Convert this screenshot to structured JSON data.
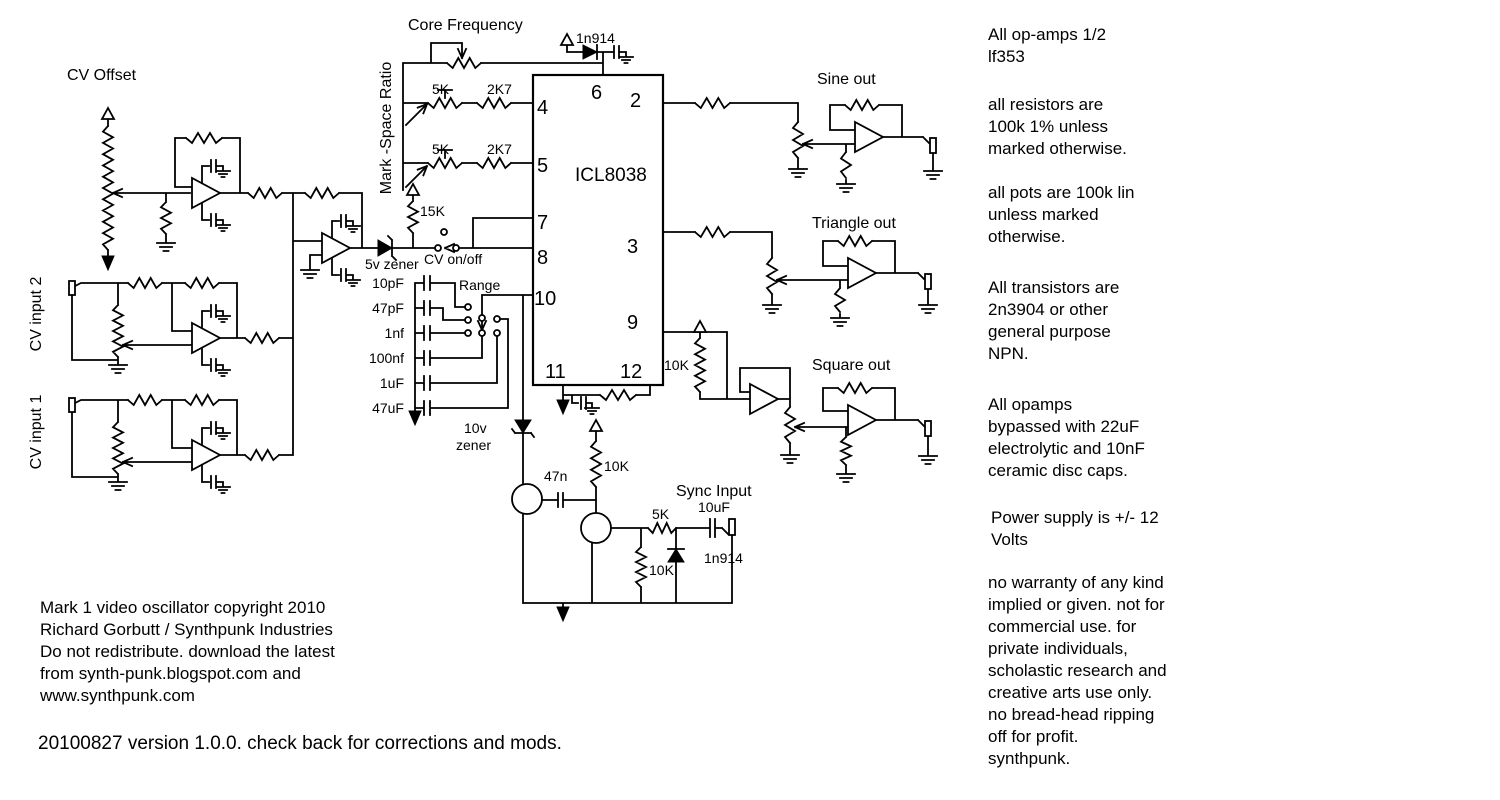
{
  "schematic": {
    "labels": {
      "core_frequency": "Core Frequency",
      "cv_offset": "CV Offset",
      "mark_space_ratio": "Mark -Space Ratio",
      "cv_input_2": "CV input 2",
      "cv_input_1": "CV input 1",
      "sine_out": "Sine out",
      "triangle_out": "Triangle out",
      "square_out": "Square out",
      "sync_input": "Sync Input",
      "range": "Range",
      "cv_on_off": "CV on/off",
      "zener_5v": "5v zener",
      "zener_10v_line1": "10v",
      "zener_10v_line2": "zener"
    },
    "chip": {
      "name": "ICL8038",
      "pins": {
        "p2": "2",
        "p3": "3",
        "p4": "4",
        "p5": "5",
        "p6": "6",
        "p7": "7",
        "p8": "8",
        "p9": "9",
        "p10": "10",
        "p11": "11",
        "p12": "12"
      }
    },
    "values": {
      "diode_core": "1n914",
      "pot_5k_top": "5K",
      "res_2k7_top": "2K7",
      "pot_5k_bottom": "5K",
      "res_2k7_bottom": "2K7",
      "res_15k": "15K",
      "timing_caps": [
        "10pF",
        "47pF",
        "1nf",
        "100nf",
        "1uF",
        "47uF"
      ],
      "res_10k_square": "10K",
      "cap_47n": "47n",
      "res_10k_sync_pullup": "10K",
      "res_5k_sync": "5K",
      "cap_10uf": "10uF",
      "diode_sync": "1n914",
      "res_10k_sync_ground": "10K"
    }
  },
  "notes": {
    "opamps": "All op-amps 1/2\nlf353",
    "resistors": "all resistors are\n100k 1% unless\nmarked otherwise.",
    "pots": "all pots are 100k lin\nunless marked\notherwise.",
    "transistors": "All transistors are\n2n3904 or other\ngeneral purpose\nNPN.",
    "bypass": "All opamps\nbypassed with 22uF\nelectrolytic and 10nF\nceramic disc caps.",
    "power": "Power supply is +/- 12\nVolts",
    "disclaimer": "no warranty of any kind\nimplied or given. not for\ncommercial use. for\nprivate individuals,\nscholastic research and\ncreative arts use only.\nno bread-head ripping\noff for profit.\nsynthpunk."
  },
  "footer": {
    "copyright": "Mark 1 video oscillator copyright 2010\nRichard Gorbutt / Synthpunk Industries\nDo not redistribute. download the latest\nfrom synth-punk.blogspot.com and\nwww.synthpunk.com",
    "version": "20100827 version 1.0.0. check back for corrections and mods."
  }
}
